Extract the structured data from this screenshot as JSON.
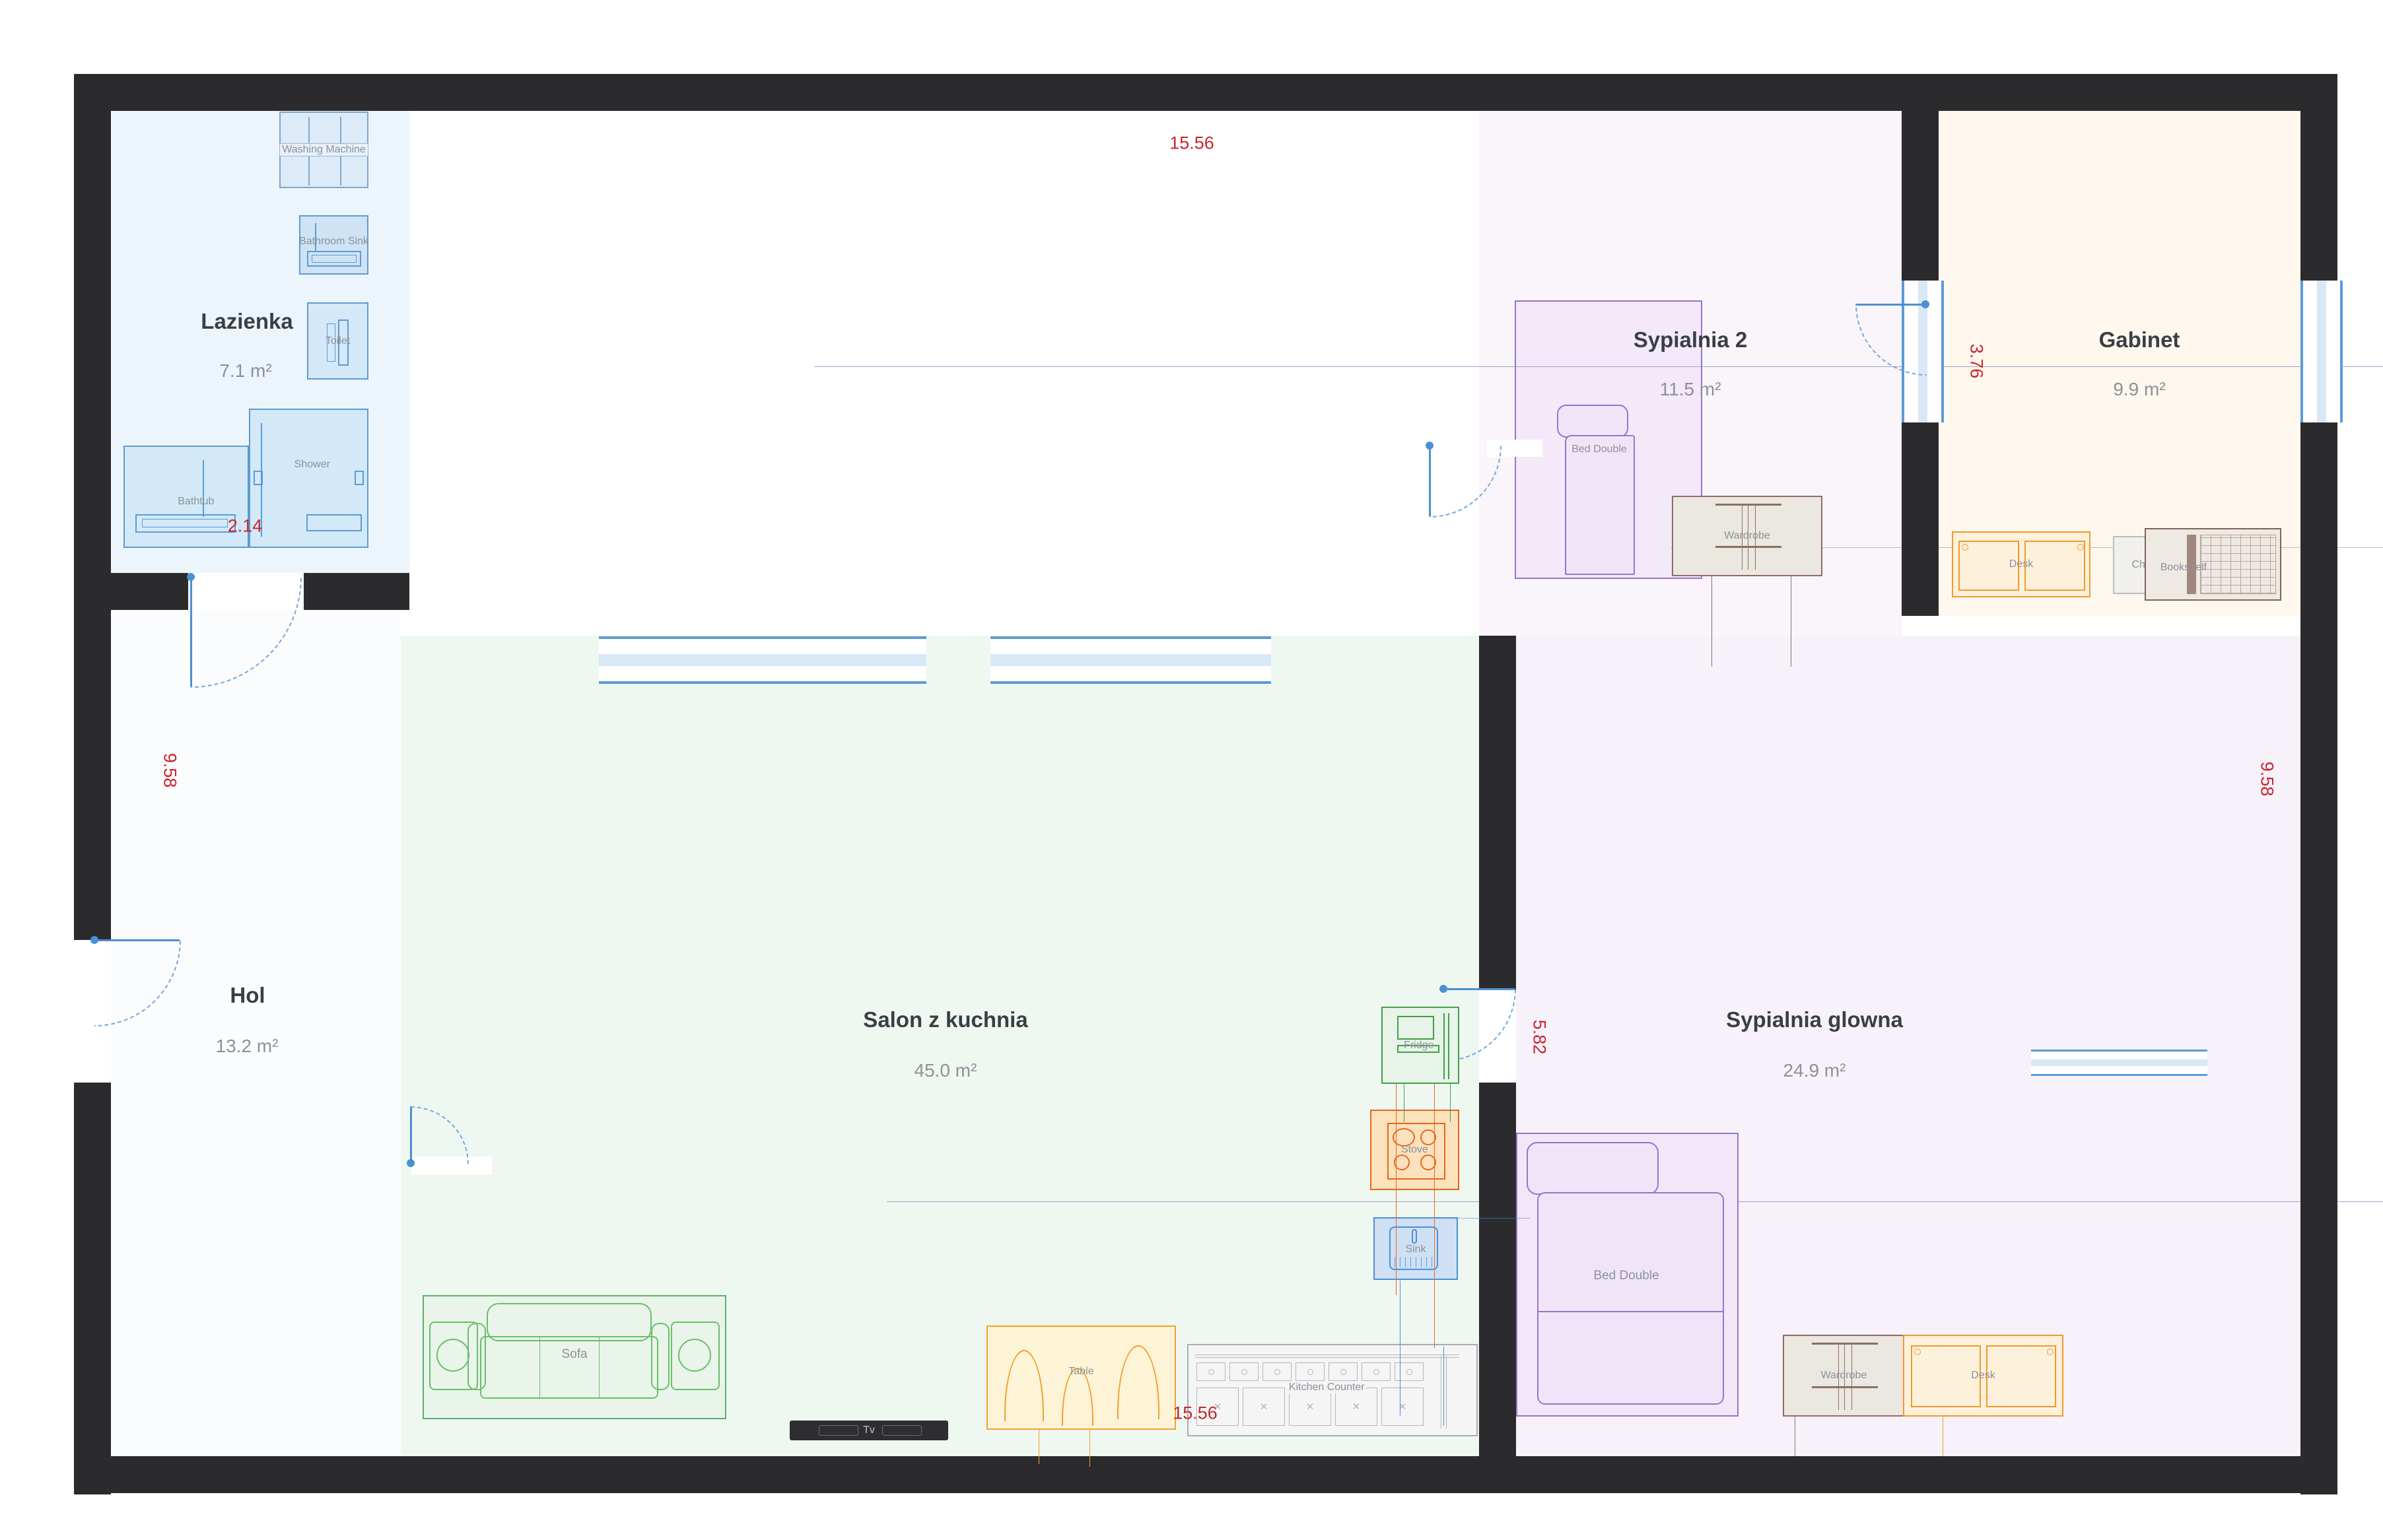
{
  "rooms": {
    "lazienka": {
      "name": "Lazienka",
      "area": "7.1 m²"
    },
    "sypialnia2": {
      "name": "Sypialnia 2",
      "area": "11.5 m²"
    },
    "gabinet": {
      "name": "Gabinet",
      "area": "9.9 m²"
    },
    "hol": {
      "name": "Hol",
      "area": "13.2 m²"
    },
    "salon": {
      "name": "Salon z kuchnia",
      "area": "45.0 m²"
    },
    "master": {
      "name": "Sypialnia glowna",
      "area": "24.9 m²"
    }
  },
  "furniture": {
    "washing_machine": "Washing Machine",
    "bathroom_sink": "Bathroom Sink",
    "toilet": "Toilet",
    "bathtub": "Bathtub",
    "shower": "Shower",
    "bed_double": "Bed Double",
    "wardrobe": "Wardrobe",
    "desk": "Desk",
    "chair": "Chair",
    "bookshelf": "Bookshelf",
    "sofa": "Sofa",
    "table": "Table",
    "kitchen_counter": "Kitchen Counter",
    "fridge": "Fridge",
    "stove": "Stove",
    "sink": "Sink",
    "tv": "Tv"
  },
  "dimensions": {
    "width_top": "15.56",
    "width_bottom": "15.56",
    "bath_width": "2.14",
    "gabinet_height": "3.76",
    "height_left": "9.58",
    "height_right": "9.58",
    "master_height": "5.82"
  },
  "colors": {
    "wall": "#2b2b2e",
    "door_blue": "#4a90d2",
    "dim_red": "#c9252d",
    "lazienka_fill": "#ecf5fb",
    "salon_fill": "#eff7f1",
    "master_fill": "#f7f2fa",
    "gabinet_fill": "#fdf7ee",
    "sypialnia2_fill": "#f3e9f8",
    "furniture_blue": "#5b9bd5",
    "furniture_purple": "#9575cd",
    "furniture_orange": "#f09a2e",
    "furniture_green": "#43a047",
    "furniture_brown": "#8d6e63"
  }
}
